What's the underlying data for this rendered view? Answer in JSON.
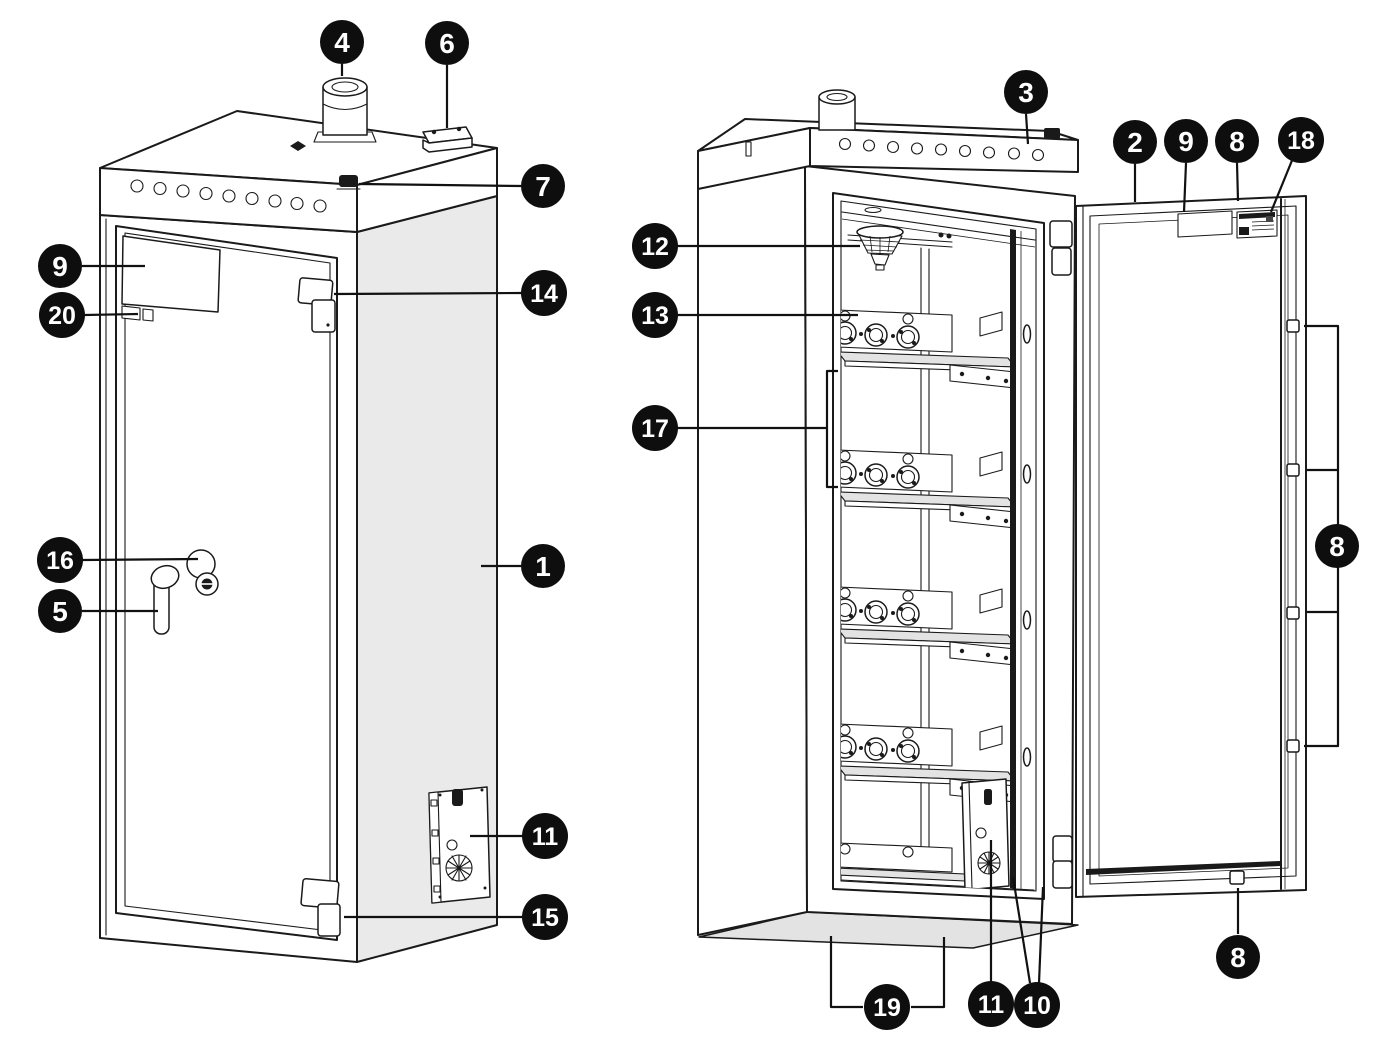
{
  "diagram": {
    "type": "technical-line-illustration",
    "views": [
      {
        "id": "closed-cabinet",
        "description": "cabinet shown closed, front-left view"
      },
      {
        "id": "open-cabinet",
        "description": "cabinet shown open with shelves and modules, door swung right"
      }
    ]
  },
  "colors": {
    "background": "#ffffff",
    "line": "#1a1a1a",
    "side_panel_gray": "#eaeaea",
    "shelf_gray": "#e3e3e3",
    "floor_gray": "#e3e3e3",
    "callout_bg": "#0e0e0e",
    "callout_text": "#ffffff"
  },
  "callouts": [
    {
      "label": "4",
      "suffix": "",
      "x": 342,
      "y": 42,
      "points_to": "roof-vent-cylinder",
      "leaders": [
        [
          [
            342,
            76
          ],
          [
            342,
            64
          ]
        ]
      ]
    },
    {
      "label": "6",
      "suffix": "",
      "x": 447,
      "y": 43,
      "points_to": "roof-box",
      "leaders": [
        [
          [
            447,
            128
          ],
          [
            447,
            65
          ]
        ]
      ]
    },
    {
      "label": "7",
      "suffix": "",
      "x": 543,
      "y": 186,
      "points_to": "roof-bolt",
      "leaders": [
        [
          [
            359,
            184
          ],
          [
            521,
            186
          ]
        ]
      ]
    },
    {
      "label": "9",
      "suffix": "",
      "x": 60,
      "y": 266,
      "points_to": "door-document-pocket",
      "leaders": [
        [
          [
            145,
            266
          ],
          [
            82,
            266
          ]
        ]
      ]
    },
    {
      "label": "20",
      "suffix": "",
      "x": 62,
      "y": 315,
      "points_to": "door-small-label",
      "leaders": [
        [
          [
            138,
            314
          ],
          [
            85,
            315
          ]
        ]
      ]
    },
    {
      "label": "14",
      "suffix": "",
      "x": 544,
      "y": 293,
      "points_to": "upper-hinge",
      "leaders": [
        [
          [
            334,
            294
          ],
          [
            522,
            293
          ]
        ]
      ]
    },
    {
      "label": "16",
      "suffix": "",
      "x": 60,
      "y": 560,
      "points_to": "cylinder-lock",
      "leaders": [
        [
          [
            198,
            559
          ],
          [
            82,
            560
          ]
        ]
      ]
    },
    {
      "label": "5",
      "suffix": "",
      "x": 60,
      "y": 611,
      "points_to": "door-handle",
      "leaders": [
        [
          [
            158,
            611
          ],
          [
            82,
            611
          ]
        ]
      ]
    },
    {
      "label": "1",
      "suffix": "",
      "x": 543,
      "y": 566,
      "points_to": "cabinet-body-side-panel",
      "leaders": [
        [
          [
            481,
            566
          ],
          [
            521,
            566
          ]
        ]
      ]
    },
    {
      "label": "11",
      "suffix": "-side",
      "x": 545,
      "y": 836,
      "points_to": "side-mounted-unit",
      "leaders": [
        [
          [
            470,
            836
          ],
          [
            523,
            836
          ]
        ]
      ]
    },
    {
      "label": "15",
      "suffix": "",
      "x": 545,
      "y": 917,
      "points_to": "lower-hinge",
      "leaders": [
        [
          [
            344,
            917
          ],
          [
            523,
            917
          ]
        ]
      ]
    },
    {
      "label": "3",
      "suffix": "",
      "x": 1026,
      "y": 92,
      "points_to": "roof-ventilation-holes",
      "leaders": [
        [
          [
            1028,
            144
          ],
          [
            1026,
            114
          ]
        ]
      ]
    },
    {
      "label": "2",
      "suffix": "",
      "x": 1135,
      "y": 142,
      "points_to": "door-inner-face",
      "leaders": [
        [
          [
            1135,
            202
          ],
          [
            1135,
            164
          ]
        ]
      ]
    },
    {
      "label": "9",
      "suffix": "-door",
      "x": 1186,
      "y": 141,
      "points_to": "door-label",
      "leaders": [
        [
          [
            1184,
            212
          ],
          [
            1186,
            163
          ]
        ]
      ]
    },
    {
      "label": "8",
      "suffix": "-top",
      "x": 1237,
      "y": 141,
      "points_to": "door-top-bolt",
      "leaders": [
        [
          [
            1238,
            201
          ],
          [
            1237,
            163
          ]
        ]
      ]
    },
    {
      "label": "18",
      "suffix": "",
      "x": 1301,
      "y": 140,
      "points_to": "rating-label",
      "leaders": [
        [
          [
            1271,
            212
          ],
          [
            1293,
            158
          ]
        ]
      ]
    },
    {
      "label": "12",
      "suffix": "",
      "x": 655,
      "y": 246,
      "points_to": "smoke-detector",
      "leaders": [
        [
          [
            860,
            246
          ],
          [
            677,
            246
          ]
        ]
      ]
    },
    {
      "label": "13",
      "suffix": "",
      "x": 655,
      "y": 315,
      "points_to": "module-terminal-panel",
      "leaders": [
        [
          [
            858,
            315
          ],
          [
            677,
            315
          ]
        ]
      ]
    },
    {
      "label": "17",
      "suffix": "",
      "x": 655,
      "y": 428,
      "points_to": "battery-module-bay",
      "leaders": [
        [
          [
            827,
            428
          ],
          [
            677,
            428
          ]
        ],
        [
          [
            838,
            371
          ],
          [
            827,
            371
          ],
          [
            827,
            487
          ],
          [
            838,
            487
          ]
        ]
      ]
    },
    {
      "label": "8",
      "suffix": "-bolts",
      "x": 1337,
      "y": 546,
      "points_to": "door-locking-bolts",
      "leaders": [
        [
          [
            1304,
            326
          ],
          [
            1338,
            326
          ],
          [
            1338,
            746
          ],
          [
            1304,
            746
          ]
        ],
        [
          [
            1307,
            470
          ],
          [
            1338,
            470
          ]
        ],
        [
          [
            1307,
            612
          ],
          [
            1338,
            612
          ]
        ]
      ]
    },
    {
      "label": "8",
      "suffix": "-bottom",
      "x": 1238,
      "y": 957,
      "points_to": "door-bottom-bolt",
      "leaders": [
        [
          [
            1238,
            888
          ],
          [
            1238,
            934
          ]
        ]
      ]
    },
    {
      "label": "19",
      "suffix": "",
      "x": 887,
      "y": 1007,
      "points_to": "floor-anchor-points",
      "leaders": [
        [
          [
            831,
            936
          ],
          [
            831,
            1007
          ],
          [
            863,
            1007
          ]
        ],
        [
          [
            944,
            937
          ],
          [
            944,
            1007
          ],
          [
            911,
            1007
          ]
        ]
      ]
    },
    {
      "label": "11",
      "suffix": "-internal",
      "x": 991,
      "y": 1004,
      "points_to": "internal-unit",
      "leaders": [
        [
          [
            991,
            840
          ],
          [
            991,
            981
          ]
        ]
      ]
    },
    {
      "label": "10",
      "suffix": "",
      "x": 1037,
      "y": 1005,
      "points_to": "door-frame-seal",
      "leaders": [
        [
          [
            1013,
            877
          ],
          [
            1030,
            983
          ]
        ],
        [
          [
            1043,
            887
          ],
          [
            1039,
            983
          ]
        ]
      ]
    }
  ]
}
